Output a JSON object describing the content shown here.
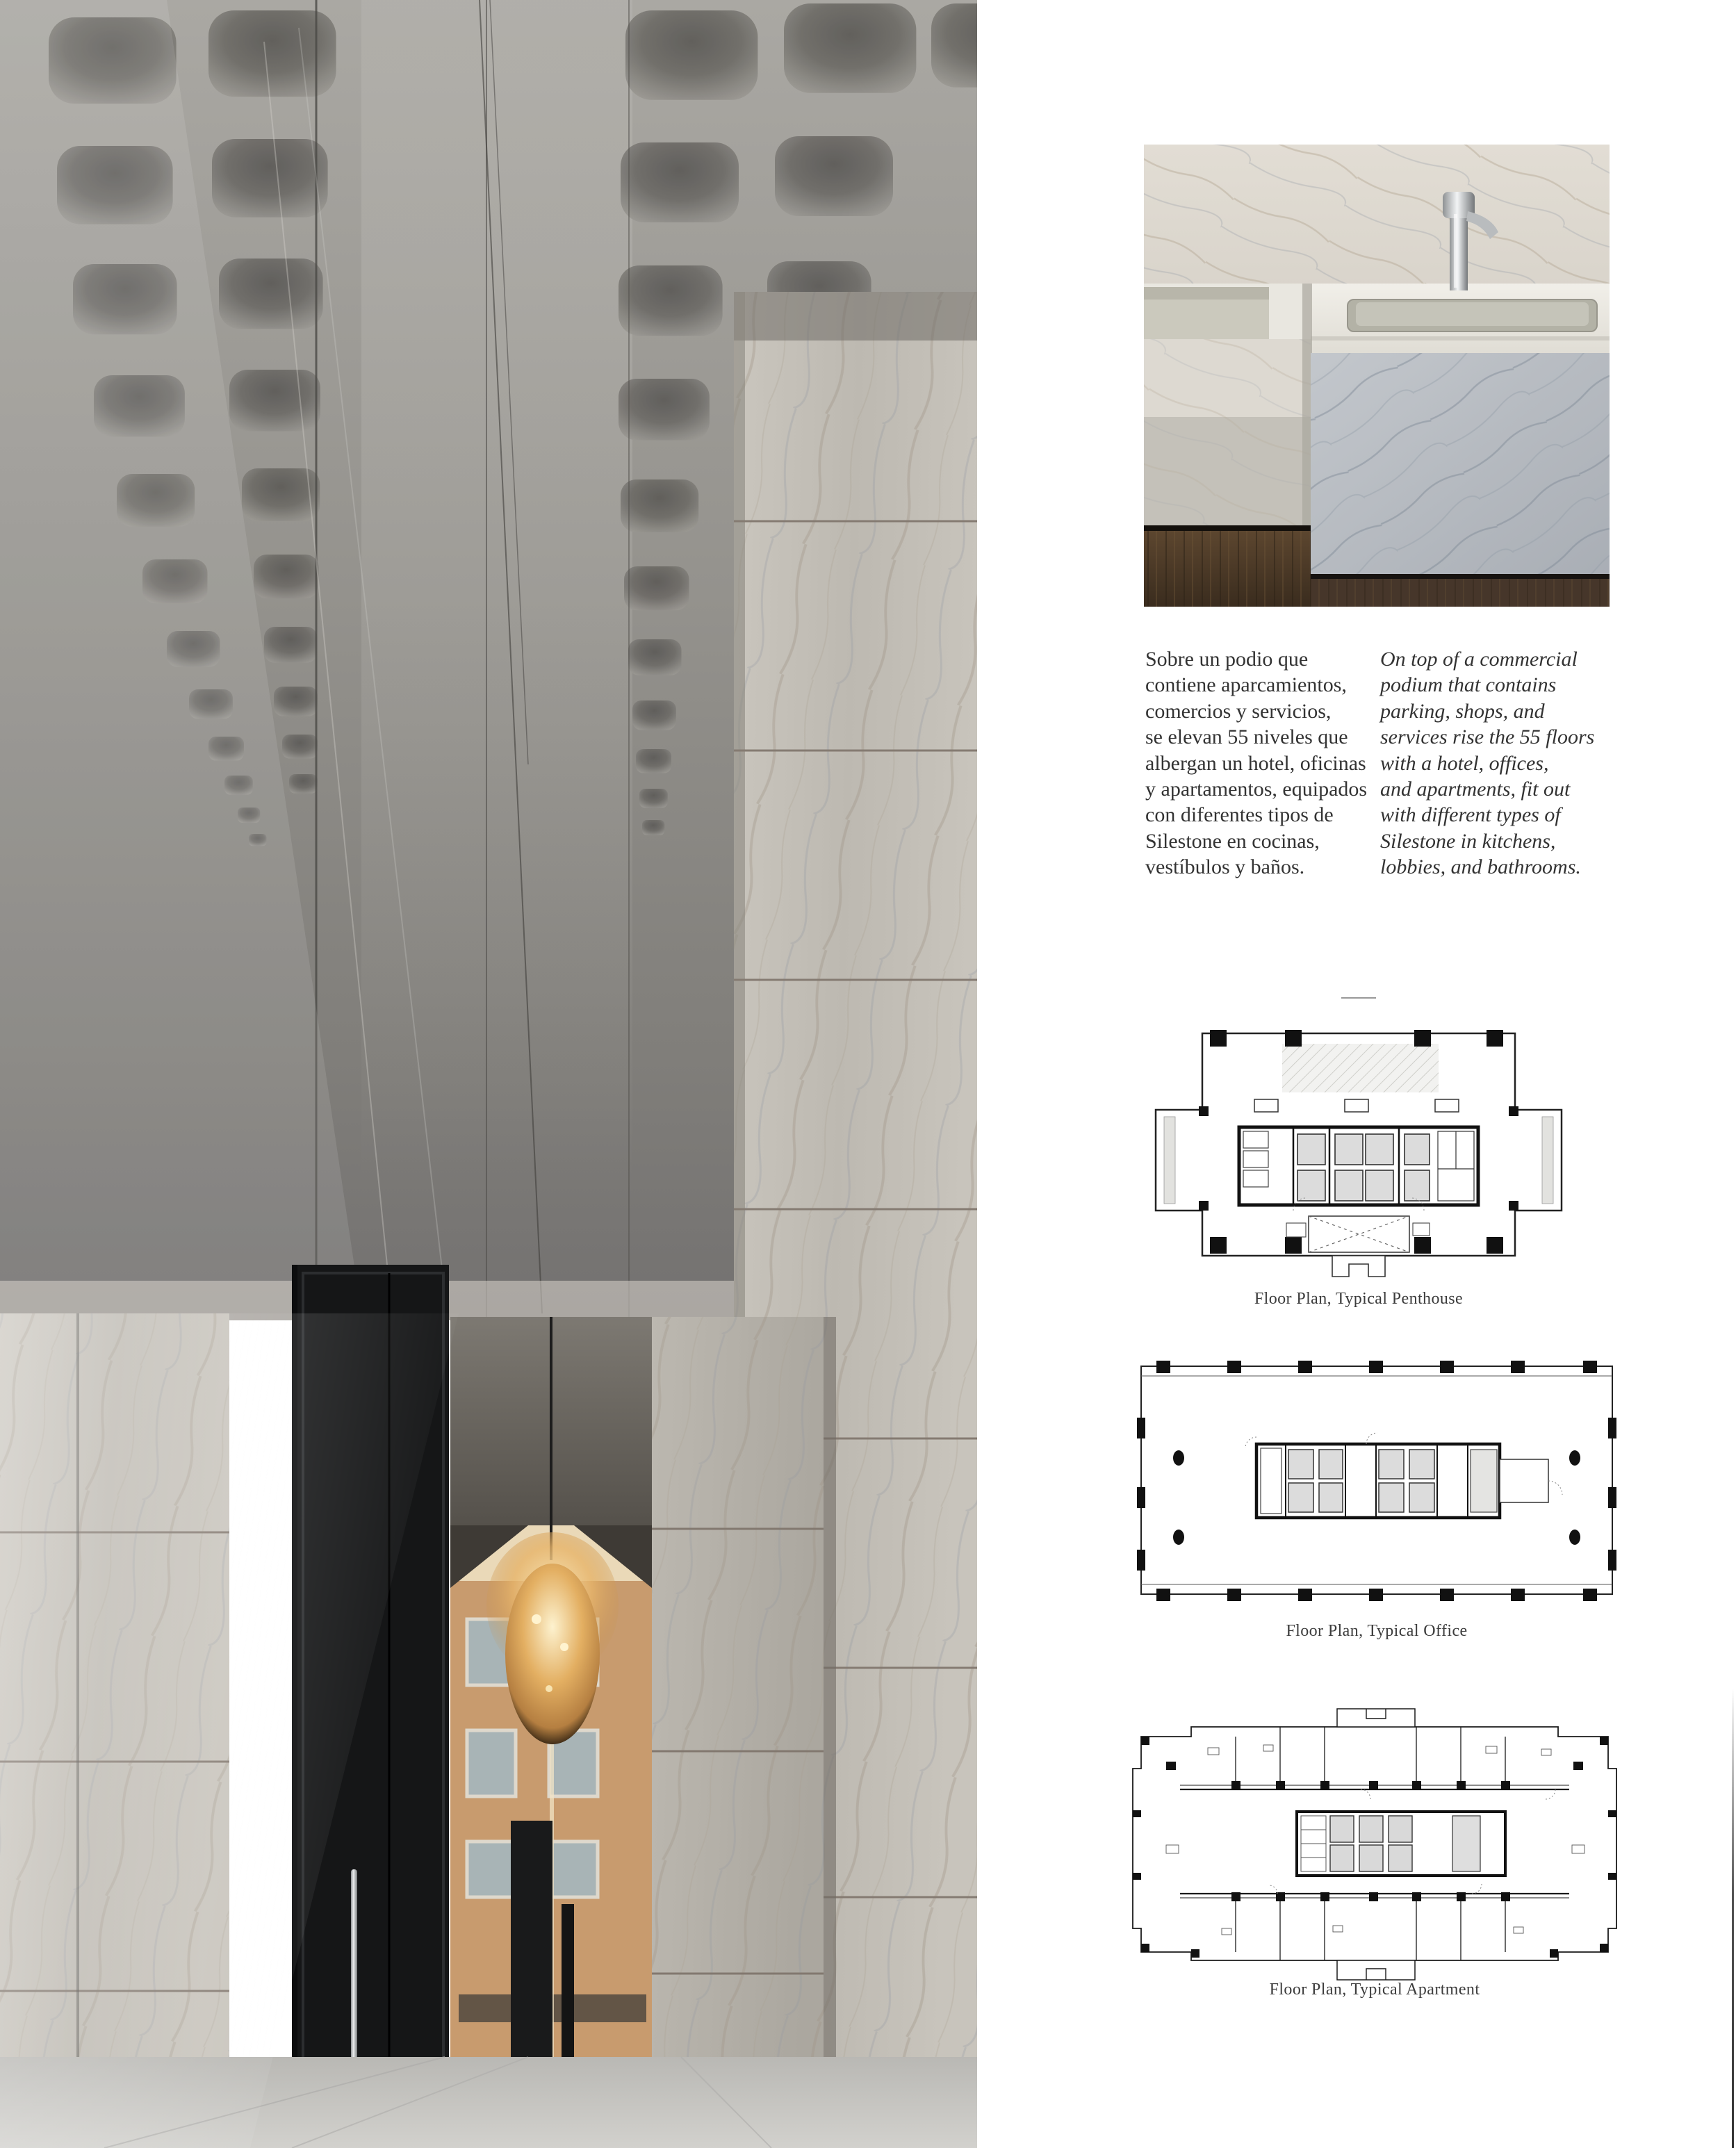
{
  "body_text": {
    "es_lines": [
      "Sobre un podio que",
      "contiene aparcamientos,",
      "comercios y servicios,",
      "se elevan 55 niveles que",
      "albergan un hotel, oficinas",
      "y apartamentos, equipados",
      "con diferentes tipos de",
      "Silestone en cocinas,",
      "vestíbulos y baños."
    ],
    "en_lines": [
      "On top of a commercial",
      "podium that contains",
      "parking, shops, and",
      "services rise the 55 floors",
      "with a hotel, offices,",
      "and apartments, fit out",
      "with different types of",
      "Silestone in kitchens,",
      "lobbies, and bathrooms."
    ]
  },
  "captions": {
    "penthouse": "Floor Plan, Typical Penthouse",
    "office": "Floor Plan, Typical Office",
    "apartment": "Floor Plan, Typical Apartment"
  },
  "colors": {
    "page_bg": "#ffffff",
    "text": "#333333",
    "caption": "#3c3c3c",
    "plan_line": "#1c1c1c",
    "marble_light": "#c6c2ba",
    "chandelier_gold": "#e8b96a",
    "wood": "#4e3b2a"
  }
}
